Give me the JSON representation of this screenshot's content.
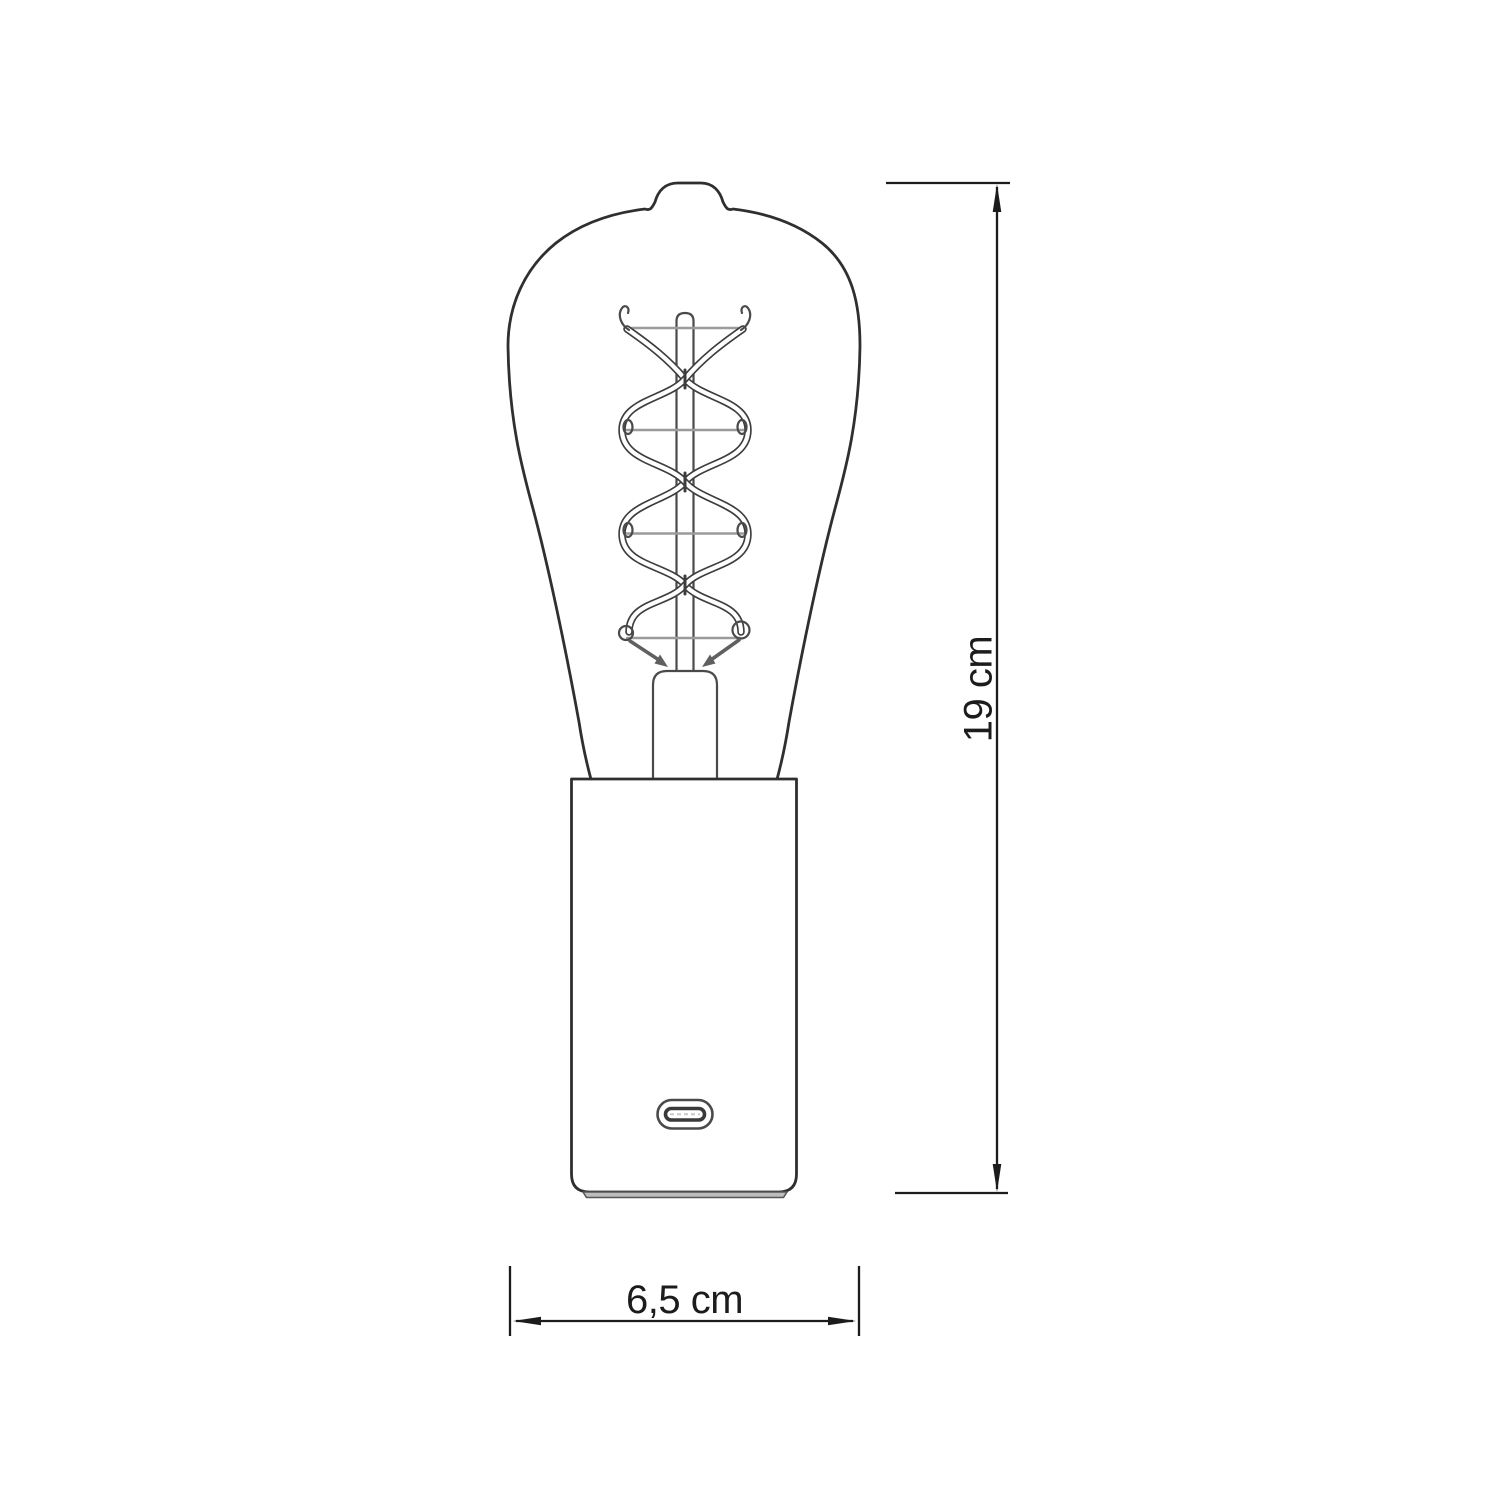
{
  "diagram": {
    "type": "product-dimension-drawing",
    "subject": "edison-filament-bulb-lamp-with-usb-c-base",
    "height_dimension": {
      "label": "19 cm",
      "orientation": "vertical"
    },
    "width_dimension": {
      "label": "6,5 cm",
      "orientation": "horizontal"
    },
    "colors": {
      "background": "#ffffff",
      "outline": "#2f2f2f",
      "dimension": "#1c1c1c",
      "wire": "#9b9b9b",
      "lead": "#606060",
      "detail": "#4a4a4a",
      "filament": "#3d3d3d",
      "foot": "#bdbdbd"
    }
  }
}
